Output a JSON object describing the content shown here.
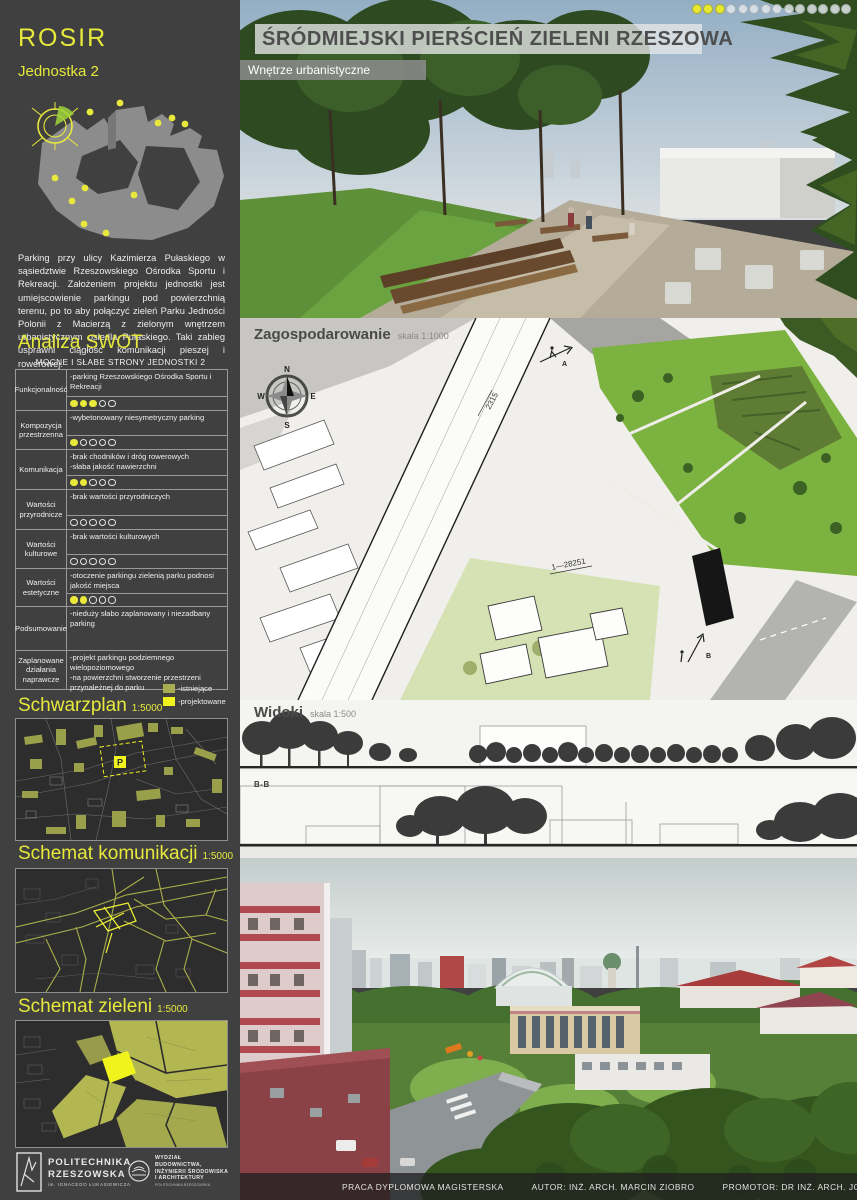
{
  "header": {
    "title": "ŚRÓDMIEJSKI PIERŚCIEŃ ZIELENI RZESZOWA",
    "subtitle": "Wnętrze urbanistyczne",
    "progress": {
      "filled": 3,
      "total": 14
    }
  },
  "sidebar": {
    "logo": "ROSIR",
    "unit": "Jednostka 2",
    "description": "Parking przy ulicy Kazimierza Pułaskiego w sąsiedztwie Rzeszowskiego Ośrodka Sportu i Rekreacji. Założeniem projektu jednostki jest umiejscowienie parkingu pod powierzchnią terenu, po to aby połączyć zieleń Parku Jedności Polonii z Macierzą z zielonym wnętrzem urbanistycznym osiedla Pułaskiego. Taki zabieg usprawni ciągłość komunikacji pieszej i rowerowej.",
    "swot_title": "Analiza SWOT",
    "swot_table": {
      "header": "MOCNE I SŁABE STRONY JEDNOSTKI 2",
      "rating_max": 5,
      "rows": [
        {
          "label": "Funkcjonalność",
          "text": "-parking Rzeszowskiego Ośrodka Sportu i Rekreacji",
          "rating": 3
        },
        {
          "label": "Kompozycja przestrzenna",
          "text": "-wybetonowany niesymetryczny parking",
          "rating": 1
        },
        {
          "label": "Komunikacja",
          "text": "-brak chodników i dróg rowerowych\n-słaba jakość nawierzchni",
          "rating": 2
        },
        {
          "label": "Wartości przyrodnicze",
          "text": "-brak wartości przyrodniczych",
          "rating": 0
        },
        {
          "label": "Wartości kulturowe",
          "text": "-brak wartości kulturowych",
          "rating": 0
        },
        {
          "label": "Wartości estetyczne",
          "text": "-otoczenie parkingu zielenią parku podnosi jakość miejsca",
          "rating": 2
        },
        {
          "label": "Podsumowanie",
          "text": "-nieduży słabo zaplanowany i niezadbany parking"
        },
        {
          "label": "Zaplanowane działania naprawcze",
          "text": "-projekt parkingu podziemnego wielopoziomowego\n-na powierzchni stworzenie przestrzeni przynależnej do parku"
        }
      ]
    },
    "legend": {
      "existing_label": "-istniejące",
      "planned_label": "-projektowane",
      "existing_color": "#a8ad52",
      "planned_color": "#f0f41c"
    },
    "maps": [
      {
        "title": "Schwarzplan",
        "scale": "1:5000"
      },
      {
        "title": "Schemat komunikacji",
        "scale": "1:5000"
      },
      {
        "title": "Schemat zieleni",
        "scale": "1:5000"
      }
    ],
    "schwarzplan_marker": "P",
    "logos": {
      "university": "POLITECHNIKA\nRZESZOWSKA",
      "university_sub": "im. IGNACEGO ŁUKASIEWICZA",
      "faculty": "WYDZIAŁ\nBUDOWNICTWA,\nINŻYNIERII ŚRODOWISKA\nI ARCHITEKTURY",
      "faculty_sub": "POLITECHNIKA RZESZOWSKA"
    }
  },
  "plan": {
    "title": "Zagospodarowanie",
    "scale": "skala 1:1000",
    "compass_n": "N",
    "compass_e": "E",
    "compass_s": "S",
    "compass_w": "W",
    "road_label_1": "2315",
    "road_label_2": "1—28251",
    "section_a": "A",
    "section_b": "B"
  },
  "views": {
    "title": "Widoki",
    "scale": "skala 1:500",
    "section_a": "A-A",
    "section_b": "B-B"
  },
  "footer": {
    "thesis": "PRACA DYPLOMOWA MAGISTERSKA",
    "author": "AUTOR: INŻ. ARCH. MARCIN ZIOBRO",
    "promoter": "PROMOTOR: DR INŻ. ARCH. JOANNA DUDEK"
  },
  "colors": {
    "accent_yellow": "#e6e93c",
    "sidebar_bg": "#404040",
    "olive_existing": "#a8ad52",
    "bright_planned": "#f0f41c",
    "park_green": "#7cb23f"
  }
}
